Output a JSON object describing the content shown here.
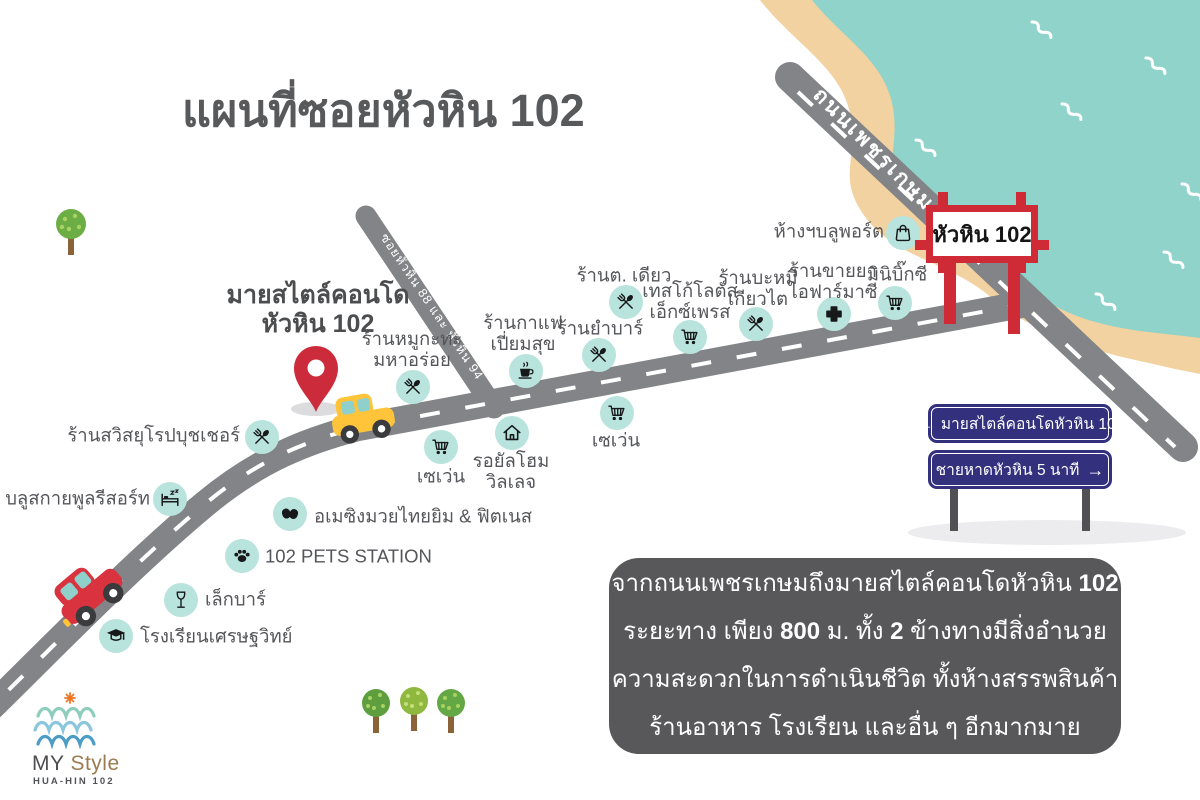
{
  "title": "แผนที่ซอยหัวหิน 102",
  "colors": {
    "sea": "#8FD3CB",
    "sand": "#F2D2A0",
    "road": "#828487",
    "accent_red": "#CE2B36",
    "sign_navy": "#33307D",
    "dark_gray": "#58595B",
    "icon_mint": "#B9E3DD"
  },
  "map": {
    "phetkasem_label": "ถนนเพชรเกษม",
    "branch_label": "ซอยหัวหิน 88 และ หัวหิน 94",
    "gate_sign_label": "หัวหิน 102"
  },
  "condo": {
    "line1": "มายสไตล์คอนโด",
    "line2": "หัวหิน 102"
  },
  "landmarks": [
    {
      "id": "swiss-euro-butcher",
      "icon": "cutlery",
      "ix": 262,
      "iy": 437,
      "label": "ร้านสวิสยุโรปบุชเชอร์",
      "lx": 240,
      "ly": 436,
      "align": "right"
    },
    {
      "id": "bluesky-pool-resort",
      "icon": "bed",
      "ix": 170,
      "iy": 499,
      "label": "บลูสกายพูลรีสอร์ท",
      "lx": 150,
      "ly": 499,
      "align": "right"
    },
    {
      "id": "amazing-muaythai-gym",
      "icon": "boxing",
      "ix": 290,
      "iy": 514,
      "label": "อเมซิงมวยไทยยิม & ฟิตเนส",
      "lx": 314,
      "ly": 517,
      "align": "left"
    },
    {
      "id": "102-pets-station",
      "icon": "paw",
      "ix": 242,
      "iy": 556,
      "label": "102 PETS STATION",
      "lx": 265,
      "ly": 557,
      "align": "left"
    },
    {
      "id": "lek-bar",
      "icon": "wine",
      "ix": 181,
      "iy": 600,
      "label": "เล็กบาร์",
      "lx": 205,
      "ly": 600,
      "align": "left"
    },
    {
      "id": "setthawit-school",
      "icon": "gradcap",
      "ix": 116,
      "iy": 636,
      "label": "โรงเรียนเศรษฐวิทย์",
      "lx": 140,
      "ly": 637,
      "align": "left"
    },
    {
      "id": "seven-eleven-west",
      "icon": "cart",
      "ix": 441,
      "iy": 447,
      "label": "เซเว่น",
      "lx": 441,
      "ly": 477,
      "align": "center"
    },
    {
      "id": "royal-home-village",
      "icon": "house",
      "ix": 512,
      "iy": 433,
      "label": "รอยัลโฮม\nวิลเลจ",
      "lx": 511,
      "ly": 472,
      "align": "center"
    },
    {
      "id": "mookata-maha-aroi",
      "icon": "cutlery",
      "ix": 413,
      "iy": 387,
      "label": "ร้านหมูกะทะ\nมหาอร่อย",
      "lx": 412,
      "ly": 350,
      "align": "center"
    },
    {
      "id": "coffee-piamsuk",
      "icon": "coffee",
      "ix": 526,
      "iy": 371,
      "label": "ร้านกาแฟ\nเปี่ยมสุข",
      "lx": 523,
      "ly": 334,
      "align": "center"
    },
    {
      "id": "yam-bar",
      "icon": "cutlery",
      "ix": 599,
      "iy": 355,
      "label": "ร้านยำบาร์",
      "lx": 600,
      "ly": 329,
      "align": "center"
    },
    {
      "id": "tor-diao",
      "icon": "cutlery",
      "ix": 626,
      "iy": 302,
      "label": "ร้านต. เดียว",
      "lx": 624,
      "ly": 276,
      "align": "center"
    },
    {
      "id": "tesco-lotus-express",
      "icon": "cart",
      "ix": 690,
      "iy": 337,
      "label": "เทสโก้โลตัส\nเอ็กซ์เพรส",
      "lx": 690,
      "ly": 302,
      "align": "center"
    },
    {
      "id": "noodle-kiao-tai",
      "icon": "cutlery",
      "ix": 756,
      "iy": 324,
      "label": "ร้านบะหมี\nเกียวไต",
      "lx": 758,
      "ly": 289,
      "align": "center"
    },
    {
      "id": "i-pharmacy",
      "icon": "cross",
      "ix": 834,
      "iy": 314,
      "label": "ร้านขายยา\nไอฟาร์มาซี",
      "lx": 833,
      "ly": 282,
      "align": "center"
    },
    {
      "id": "mini-bigc",
      "icon": "cart",
      "ix": 895,
      "iy": 303,
      "label": "มินิบิ๊กซี",
      "lx": 897,
      "ly": 275,
      "align": "center"
    },
    {
      "id": "bluport-mall",
      "icon": "bag",
      "ix": 903,
      "iy": 233,
      "label": "ห้างฯบลูพอร์ต",
      "lx": 884,
      "ly": 232,
      "align": "right"
    },
    {
      "id": "seven-eleven-east",
      "icon": "cart",
      "ix": 617,
      "iy": 413,
      "label": "เซเว่น",
      "lx": 616,
      "ly": 441,
      "align": "center"
    }
  ],
  "direction_signs": [
    {
      "text": "มายสไตล์คอนโดหัวหิน 102",
      "arrow": "←",
      "arrow_side": "left"
    },
    {
      "text": "ชายหาดหัวหิน 5 นาที",
      "arrow": "→",
      "arrow_side": "right"
    }
  ],
  "info_box": {
    "lines": [
      [
        {
          "t": "จากถนนเพชรเกษมถึงมายสไตล์คอนโดหัวหิน "
        },
        {
          "t": "102",
          "b": true
        }
      ],
      [
        {
          "t": "ระยะทาง เพียง "
        },
        {
          "t": "800",
          "b": true
        },
        {
          "t": " ม. ทั้ง "
        },
        {
          "t": "2",
          "b": true
        },
        {
          "t": " ข้างทางมีสิ่งอำนวย"
        }
      ],
      [
        {
          "t": "ความสะดวกในการดำเนินชีวิต ทั้งห้างสรรพสินค้า"
        }
      ],
      [
        {
          "t": "ร้านอาหาร โรงเรียน และอื่น ๆ อีกมากมาย"
        }
      ]
    ]
  },
  "logo": {
    "brand_prefix": "MY ",
    "brand_suffix": "Style",
    "subtitle": "HUA-HIN 102"
  }
}
